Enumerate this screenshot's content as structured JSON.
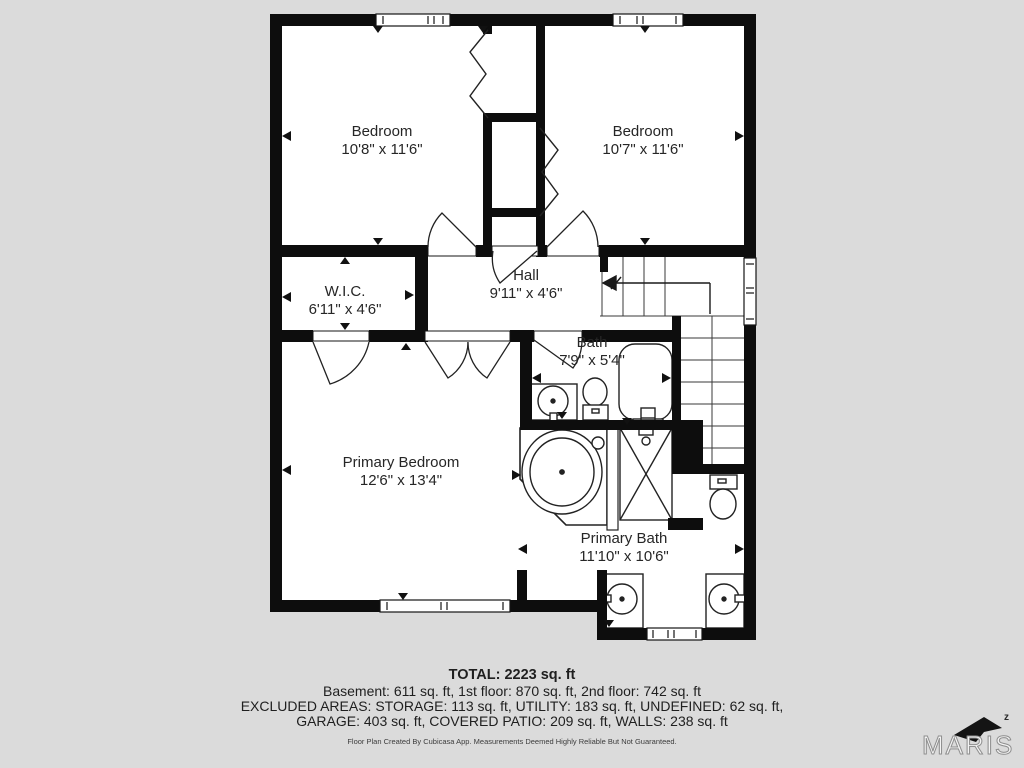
{
  "rooms": {
    "bedroom_left": {
      "name": "Bedroom",
      "dims": "10'8\" x 11'6\""
    },
    "bedroom_right": {
      "name": "Bedroom",
      "dims": "10'7\" x 11'6\""
    },
    "wic": {
      "name": "W.I.C.",
      "dims": "6'11\" x 4'6\""
    },
    "hall": {
      "name": "Hall",
      "dims": "9'11\" x 4'6\""
    },
    "bath": {
      "name": "Bath",
      "dims": "7'9\" x 5'4\""
    },
    "primary_bedroom": {
      "name": "Primary Bedroom",
      "dims": "12'6\" x 13'4\""
    },
    "primary_bath": {
      "name": "Primary Bath",
      "dims": "11'10\" x 10'6\""
    }
  },
  "summary": {
    "total": "TOTAL: 2223 sq. ft",
    "line1": "Basement: 611 sq. ft, 1st floor: 870 sq. ft, 2nd floor: 742 sq. ft",
    "line2": "EXCLUDED AREAS: STORAGE: 113 sq. ft, UTILITY: 183 sq. ft, UNDEFINED: 62 sq. ft,",
    "line3": "GARAGE: 403 sq. ft, COVERED PATIO: 209 sq. ft, WALLS: 238 sq. ft",
    "disclaimer": "Floor Plan Created By Cubicasa App. Measurements Deemed Highly Reliable But Not Guaranteed."
  },
  "logo": {
    "brand": "MARIS",
    "z": "z"
  },
  "colors": {
    "background": "#dbdbdb",
    "floor": "#ffffff",
    "walls": "#0d0d0d",
    "text": "#262626"
  }
}
